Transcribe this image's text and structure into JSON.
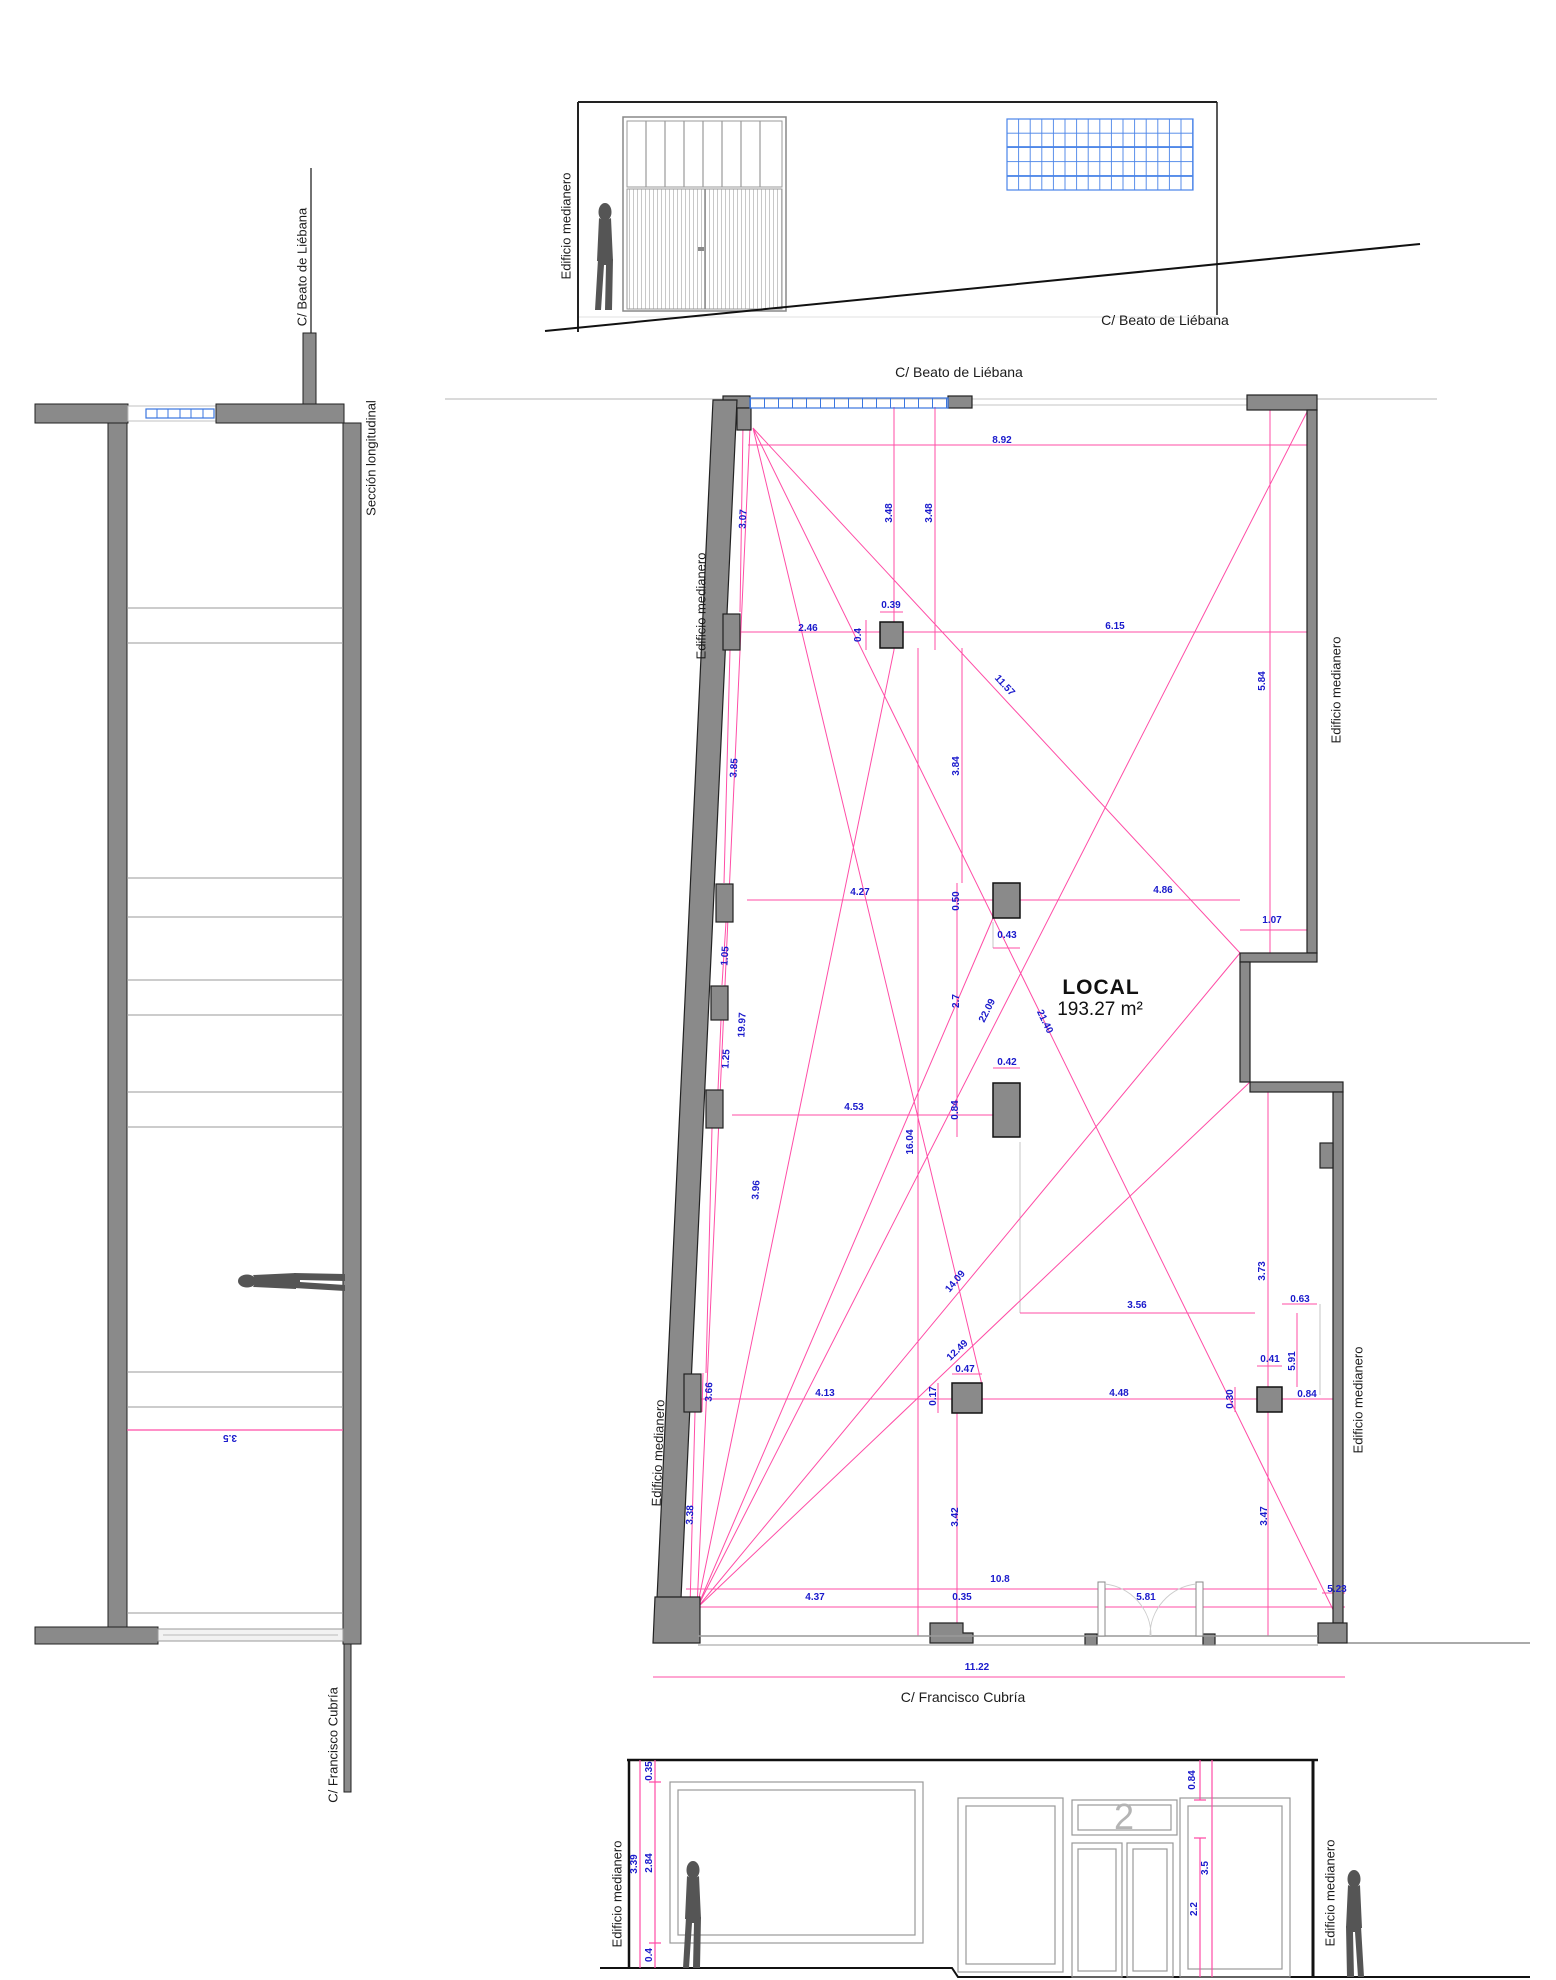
{
  "top_elevation": {
    "party_wall_label": {
      "v": "Edificio medianero",
      "x": 566,
      "y": 226,
      "r": -90
    },
    "street_label": "C/ Beato de Liébana"
  },
  "section": {
    "title": {
      "v": "Sección longitudinal",
      "x": 371,
      "y": 458,
      "r": -90
    },
    "street_top_label": {
      "v": "C/ Beato de Liébana",
      "x": 302,
      "y": 267,
      "r": -90
    },
    "street_bottom_label": {
      "v": "C/ Francisco Cubría",
      "x": 333,
      "y": 1745,
      "r": -90
    },
    "dimensions": [
      {
        "v": "3.5",
        "x": 230,
        "y": 1437,
        "r": 180
      }
    ]
  },
  "plan": {
    "room_name": "LOCAL",
    "room_area": "193.27 m²",
    "street_top_label": "C/ Beato de Liébana",
    "street_bottom_label": "C/ Francisco Cubría",
    "party_wall_labels": [
      {
        "v": "Edificio medianero",
        "x": 701,
        "y": 606,
        "r": -90
      },
      {
        "v": "Edificio medianero",
        "x": 658,
        "y": 1453,
        "r": -88
      },
      {
        "v": "Edificio medianero",
        "x": 1336,
        "y": 690,
        "r": -90
      },
      {
        "v": "Edificio medianero",
        "x": 1358,
        "y": 1400,
        "r": -90
      }
    ],
    "dimensions": [
      {
        "v": "8.92",
        "x": 1002,
        "y": 441,
        "r": 0
      },
      {
        "v": "3.48",
        "x": 890,
        "y": 513,
        "r": -90
      },
      {
        "v": "3.48",
        "x": 930,
        "y": 513,
        "r": -90
      },
      {
        "v": "3.07",
        "x": 744,
        "y": 519,
        "r": -87
      },
      {
        "v": "2.46",
        "x": 808,
        "y": 629,
        "r": 0
      },
      {
        "v": "0.39",
        "x": 891,
        "y": 606,
        "r": 0
      },
      {
        "v": "0.4",
        "x": 859,
        "y": 635,
        "r": -90
      },
      {
        "v": "6.15",
        "x": 1115,
        "y": 627,
        "r": 0
      },
      {
        "v": "11.57",
        "x": 1004,
        "y": 686,
        "r": 47
      },
      {
        "v": "5.84",
        "x": 1263,
        "y": 681,
        "r": -90
      },
      {
        "v": "3.85",
        "x": 735,
        "y": 768,
        "r": -86
      },
      {
        "v": "3.84",
        "x": 957,
        "y": 766,
        "r": -90
      },
      {
        "v": "4.27",
        "x": 860,
        "y": 893,
        "r": 0
      },
      {
        "v": "0.50",
        "x": 957,
        "y": 901,
        "r": -90
      },
      {
        "v": "4.86",
        "x": 1163,
        "y": 891,
        "r": 0
      },
      {
        "v": "1.07",
        "x": 1272,
        "y": 921,
        "r": 0
      },
      {
        "v": "0.43",
        "x": 1007,
        "y": 936,
        "r": 0
      },
      {
        "v": "1.05",
        "x": 726,
        "y": 956,
        "r": -86
      },
      {
        "v": "2.7",
        "x": 957,
        "y": 1001,
        "r": -90
      },
      {
        "v": "22.09",
        "x": 988,
        "y": 1011,
        "r": -63
      },
      {
        "v": "21.40",
        "x": 1044,
        "y": 1022,
        "r": 64
      },
      {
        "v": "19.97",
        "x": 743,
        "y": 1025,
        "r": -87
      },
      {
        "v": "1.25",
        "x": 727,
        "y": 1059,
        "r": -86
      },
      {
        "v": "0.42",
        "x": 1007,
        "y": 1063,
        "r": 0
      },
      {
        "v": "4.53",
        "x": 854,
        "y": 1108,
        "r": 0
      },
      {
        "v": "0.84",
        "x": 956,
        "y": 1110,
        "r": -90
      },
      {
        "v": "16.04",
        "x": 911,
        "y": 1142,
        "r": -90
      },
      {
        "v": "3.96",
        "x": 757,
        "y": 1190,
        "r": -86
      },
      {
        "v": "3.73",
        "x": 1263,
        "y": 1271,
        "r": -90
      },
      {
        "v": "14.09",
        "x": 956,
        "y": 1282,
        "r": -50
      },
      {
        "v": "0.63",
        "x": 1300,
        "y": 1300,
        "r": 0
      },
      {
        "v": "3.56",
        "x": 1137,
        "y": 1306,
        "r": 0
      },
      {
        "v": "12.49",
        "x": 958,
        "y": 1351,
        "r": -44
      },
      {
        "v": "0.41",
        "x": 1270,
        "y": 1360,
        "r": 0
      },
      {
        "v": "5.91",
        "x": 1293,
        "y": 1361,
        "r": -90
      },
      {
        "v": "0.47",
        "x": 965,
        "y": 1370,
        "r": 0
      },
      {
        "v": "3.66",
        "x": 710,
        "y": 1392,
        "r": -88
      },
      {
        "v": "0.17",
        "x": 934,
        "y": 1396,
        "r": -90
      },
      {
        "v": "4.13",
        "x": 825,
        "y": 1394,
        "r": 0
      },
      {
        "v": "4.48",
        "x": 1119,
        "y": 1394,
        "r": 0
      },
      {
        "v": "0.30",
        "x": 1231,
        "y": 1399,
        "r": -90
      },
      {
        "v": "0.84",
        "x": 1307,
        "y": 1395,
        "r": 0
      },
      {
        "v": "3.38",
        "x": 691,
        "y": 1515,
        "r": -88
      },
      {
        "v": "3.42",
        "x": 956,
        "y": 1517,
        "r": -90
      },
      {
        "v": "3.47",
        "x": 1265,
        "y": 1516,
        "r": -90
      },
      {
        "v": "10.8",
        "x": 1000,
        "y": 1580,
        "r": 0
      },
      {
        "v": "4.37",
        "x": 815,
        "y": 1598,
        "r": 0
      },
      {
        "v": "0.35",
        "x": 962,
        "y": 1598,
        "r": 0
      },
      {
        "v": "5.81",
        "x": 1146,
        "y": 1598,
        "r": 0
      },
      {
        "v": "5.23",
        "x": 1337,
        "y": 1590,
        "r": 0
      },
      {
        "v": "11.22",
        "x": 977,
        "y": 1668,
        "r": 0
      }
    ]
  },
  "bottom_elevation": {
    "unit_number": "2",
    "party_wall_labels": [
      {
        "v": "Edificio medianero",
        "x": 617,
        "y": 1894,
        "r": -90
      },
      {
        "v": "Edificio medianero",
        "x": 1330,
        "y": 1893,
        "r": -90
      }
    ],
    "dimensions": [
      {
        "v": "0.35",
        "x": 650,
        "y": 1771,
        "r": -90
      },
      {
        "v": "3.39",
        "x": 635,
        "y": 1864,
        "r": -90
      },
      {
        "v": "2.84",
        "x": 650,
        "y": 1863,
        "r": -90
      },
      {
        "v": "0.4",
        "x": 650,
        "y": 1955,
        "r": -90
      },
      {
        "v": "0.84",
        "x": 1193,
        "y": 1780,
        "r": -90
      },
      {
        "v": "3.5",
        "x": 1206,
        "y": 1868,
        "r": -90
      },
      {
        "v": "2.2",
        "x": 1195,
        "y": 1909,
        "r": -90
      }
    ]
  },
  "colors": {
    "dimension_text": "#1a1acc",
    "dimension_line": "#ff4da6",
    "wall_fill": "#8a8a8a",
    "glazing_blue": "#3a76e0",
    "silhouette": "#555555"
  }
}
